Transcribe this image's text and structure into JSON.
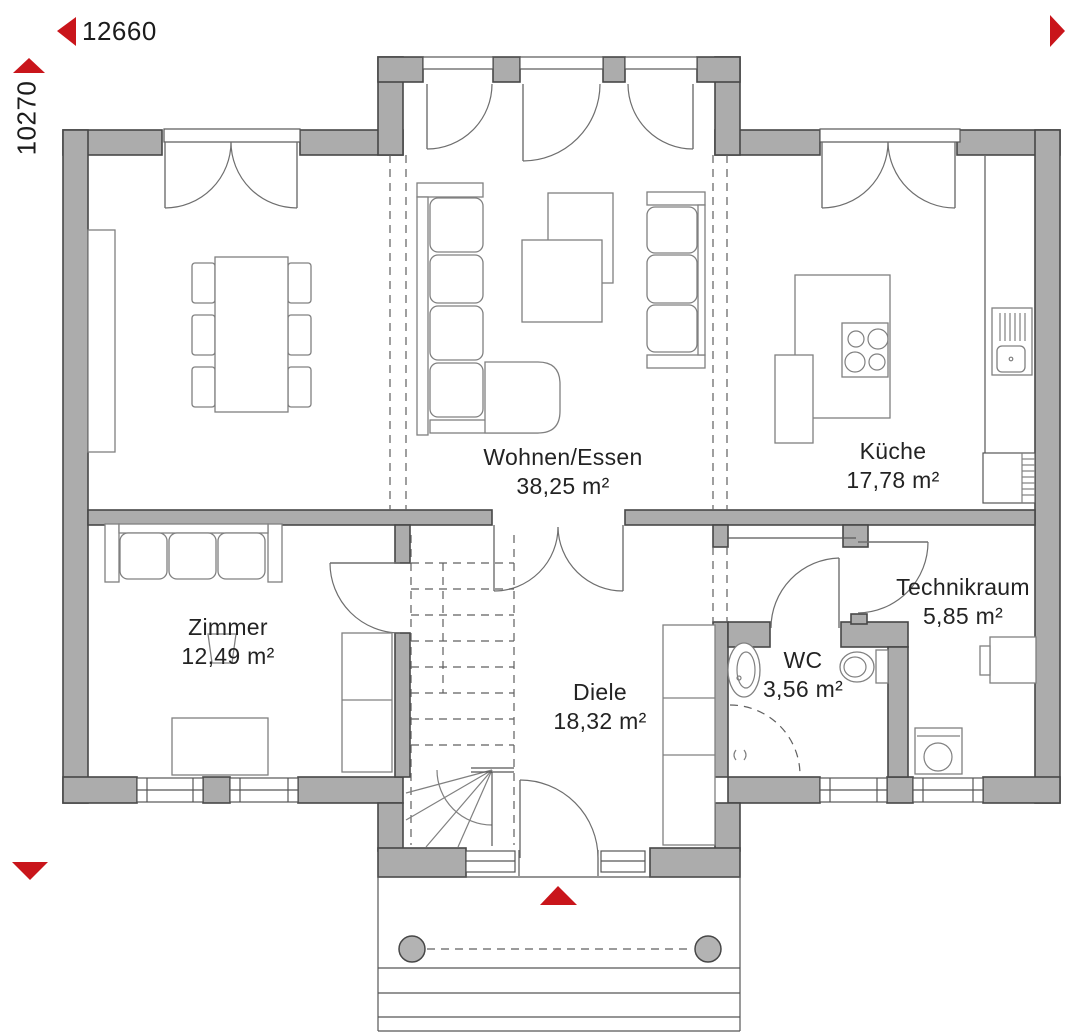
{
  "plan": {
    "dimensions": {
      "width": "12660",
      "height": "10270"
    },
    "rooms": [
      {
        "key": "wohnen_essen",
        "name": "Wohnen/Essen",
        "area": "38,25 m²"
      },
      {
        "key": "kueche",
        "name": "Küche",
        "area": "17,78 m²"
      },
      {
        "key": "zimmer",
        "name": "Zimmer",
        "area": "12,49 m²"
      },
      {
        "key": "diele",
        "name": "Diele",
        "area": "18,32 m²"
      },
      {
        "key": "wc",
        "name": "WC",
        "area": "3,56 m²"
      },
      {
        "key": "technikraum",
        "name": "Technikraum",
        "area": "5,85 m²"
      }
    ],
    "icons": {
      "dimension_arrow_left": "left-triangle",
      "dimension_arrow_right": "right-triangle",
      "dimension_arrow_up": "up-triangle",
      "dimension_arrow_down": "down-triangle",
      "entrance_arrow": "up-triangle"
    },
    "colors": {
      "wall": "#acacac",
      "line": "#474747",
      "furniture_line": "#808080",
      "accent_red": "#c9151b",
      "text": "#232323"
    }
  }
}
